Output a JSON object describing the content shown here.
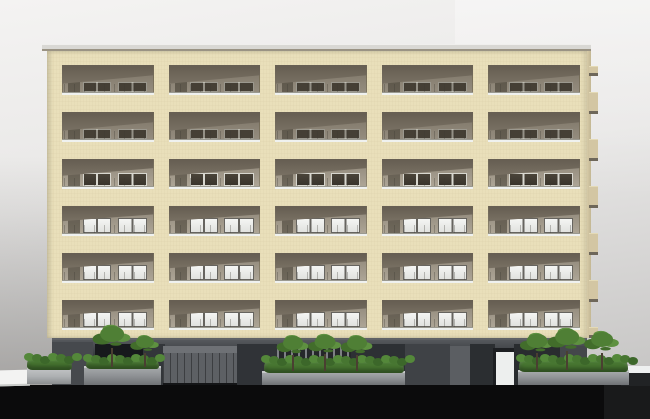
{
  "scene": {
    "description": "3D architectural rendering, front elevation of a cream-tiled 7-storey apartment building with recessed balconies, dark grey ground floor, planters with shrubs and small trees, black street shadow band",
    "colors": {
      "sky_top": "#f4f3f2",
      "sky_mid": "#e8e7e6",
      "sky_low": "#c9c8c7",
      "cornice": "#d9d8d4",
      "cornice_edge": "#9a9384",
      "facade": "#e9dfba",
      "facade_side": "#d6caa7",
      "tab": "#d3c6a3",
      "tab_shadow": "#6e675a",
      "recess_wall_top": "#8d8577",
      "recess_wall_bottom": "#b0a899",
      "ceiling_top": "#675f53",
      "ceiling_bottom": "#7d7567",
      "rail": "#eff1ef",
      "win_bright": "#f4f5f3",
      "win_frame": "#66645f",
      "win_dark": "#453f35",
      "win_dark_frame": "#d8d7cf",
      "base_top": "#55585c",
      "base_bottom": "#2e3033",
      "entrance": "#17191c",
      "garage": "#5d6064",
      "garage_lintel": "#6e7175",
      "fence_bg": "#25272a",
      "fence_slat": "#7d8084",
      "door_white": "#edefee",
      "planter": "#8f9295",
      "planter_light": "#adb0b2",
      "planter_rim": "#c8cacb",
      "hedge_dark": "#3c672a",
      "hedge_mid": "#477631",
      "hedge_light": "#54883a",
      "foliage_main": "#4f7f35",
      "foliage_dark": "#426d2b",
      "foliage_light": "#5e9140",
      "trunk": "#4a3f31",
      "ground_shadow": "#0b0b0c",
      "curb": "#eef0f0",
      "left_wall": "#f3f3f2"
    },
    "building": {
      "floors": 6,
      "bays": 5,
      "window_rows": [
        "shaded",
        "shaded",
        "dim",
        "bright",
        "bright",
        "bright"
      ],
      "geometry": {
        "first_bay_x": 15,
        "bay_width": 91.5,
        "bay_step": 106.6,
        "first_row_y": 14,
        "row_step": 47,
        "recess_height": 30
      },
      "side_tabs": {
        "count": 6,
        "start_y": 92,
        "step": 47,
        "height": 22,
        "small_tab_y": 66,
        "small_tab_h": 10
      }
    },
    "ground_floor": {
      "panels": [
        {
          "name": "wall-left",
          "x": 52,
          "y": 340,
          "w": 41,
          "h": 46,
          "color": "#46494d"
        },
        {
          "name": "entrance-recess",
          "x": 95,
          "y": 342,
          "w": 48,
          "h": 44,
          "color": "#17191c"
        },
        {
          "name": "panel-dark-a",
          "x": 143,
          "y": 342,
          "w": 22,
          "h": 44,
          "color": "#33363a"
        },
        {
          "name": "garage-lintel",
          "x": 163,
          "y": 344,
          "w": 74,
          "h": 7,
          "color": "#6e7175"
        },
        {
          "name": "garage-door",
          "x": 163,
          "y": 351,
          "w": 74,
          "h": 30,
          "color": "#5d6064",
          "texture": "ribs"
        },
        {
          "name": "garage-shadow",
          "x": 163,
          "y": 381,
          "w": 74,
          "h": 5,
          "color": "#141517"
        },
        {
          "name": "panel-dark-b",
          "x": 237,
          "y": 342,
          "w": 40,
          "h": 44,
          "color": "#303337"
        },
        {
          "name": "fence-slatted",
          "x": 277,
          "y": 344,
          "w": 74,
          "h": 23,
          "color": "#25272a",
          "texture": "slats"
        },
        {
          "name": "panel-dark-c",
          "x": 351,
          "y": 342,
          "w": 54,
          "h": 44,
          "color": "#2d3034"
        },
        {
          "name": "panel-mid-a",
          "x": 405,
          "y": 342,
          "w": 45,
          "h": 44,
          "color": "#3f4246"
        },
        {
          "name": "panel-light-a",
          "x": 450,
          "y": 344,
          "w": 20,
          "h": 42,
          "color": "#5b5e62"
        },
        {
          "name": "panel-dark-d",
          "x": 470,
          "y": 342,
          "w": 25,
          "h": 44,
          "color": "#2b2e31"
        },
        {
          "name": "door-frame",
          "x": 493,
          "y": 346,
          "w": 24,
          "h": 40,
          "color": "#1d1f22"
        },
        {
          "name": "white-door",
          "x": 496,
          "y": 350,
          "w": 18,
          "h": 36,
          "color": "#edefee"
        },
        {
          "name": "panel-dark-e",
          "x": 514,
          "y": 342,
          "w": 46,
          "h": 44,
          "color": "#292c2f"
        },
        {
          "name": "panel-mid-b",
          "x": 560,
          "y": 344,
          "w": 27,
          "h": 42,
          "color": "#44474b"
        }
      ]
    },
    "landscaping": {
      "planters": [
        {
          "name": "planter-left",
          "box": {
            "x": 27,
            "y": 367,
            "w": 44,
            "h": 17
          },
          "light": true,
          "hedge": {
            "x": 27,
            "y": 357,
            "w": 45,
            "h": 13
          },
          "trees": []
        },
        {
          "name": "planter-entry",
          "box": {
            "x": 84,
            "y": 366,
            "w": 77,
            "h": 19
          },
          "light": false,
          "hedge": {
            "x": 86,
            "y": 358,
            "w": 73,
            "h": 11
          },
          "trees": [
            {
              "cx": 112,
              "base_y": 367,
              "s": 1.25
            },
            {
              "cx": 145,
              "base_y": 367,
              "s": 0.95
            }
          ]
        },
        {
          "name": "planter-center",
          "box": {
            "x": 262,
            "y": 371,
            "w": 143,
            "h": 14
          },
          "light": false,
          "hedge": {
            "x": 264,
            "y": 359,
            "w": 140,
            "h": 14
          },
          "trees": [
            {
              "cx": 293,
              "base_y": 371,
              "s": 1.05
            },
            {
              "cx": 325,
              "base_y": 371,
              "s": 1.1
            },
            {
              "cx": 357,
              "base_y": 371,
              "s": 1.05
            }
          ]
        },
        {
          "name": "planter-right",
          "box": {
            "x": 518,
            "y": 370,
            "w": 111,
            "h": 15
          },
          "light": false,
          "hedge": {
            "x": 519,
            "y": 358,
            "w": 109,
            "h": 14
          },
          "trees": [
            {
              "cx": 537,
              "base_y": 370,
              "s": 1.1
            },
            {
              "cx": 567,
              "base_y": 370,
              "s": 1.25
            },
            {
              "cx": 602,
              "base_y": 370,
              "s": 1.15
            }
          ]
        }
      ]
    }
  }
}
